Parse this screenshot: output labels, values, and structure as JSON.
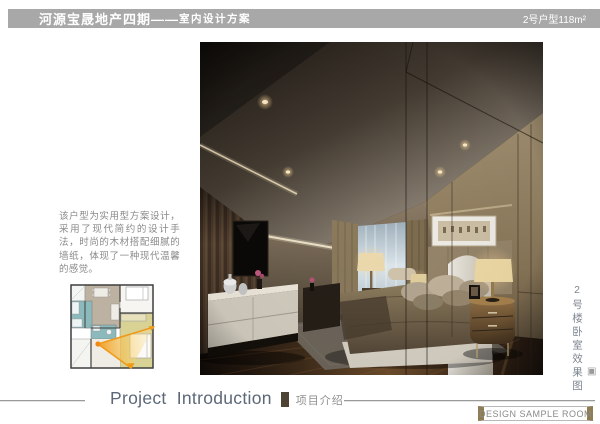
{
  "header": {
    "project_title": "河源宝晟地产四期——",
    "subtitle": "室内设计方案",
    "unit_label": "2号户型118m²"
  },
  "intro": {
    "description": "该户型为实用型方案设计，采用了现代简约的设计手法，时尚的木材搭配细腻的墙纸，体现了一种现代温馨的感觉。"
  },
  "rendering": {
    "caption": "2号楼卧室效果图"
  },
  "footer": {
    "section_title_en": "Project Introduction",
    "section_title_cn": "项目介绍",
    "badge": "DESIGN SAMPLE ROOM"
  },
  "icons": {
    "corner_mark": "▣"
  },
  "colors": {
    "header_bar": "#a8a8a8",
    "accent_olive": "#8f7c52",
    "divider_bar": "#4c4335",
    "title_blue_gray": "#5c6878",
    "body_text_gray": "#8a8a8a",
    "plan_kitchen_teal": "#8cb9bb",
    "plan_living_tan": "#bdb1a1",
    "plan_master_yellow": "#d9d295",
    "plan_view_cone_orange": "#f08a15"
  }
}
